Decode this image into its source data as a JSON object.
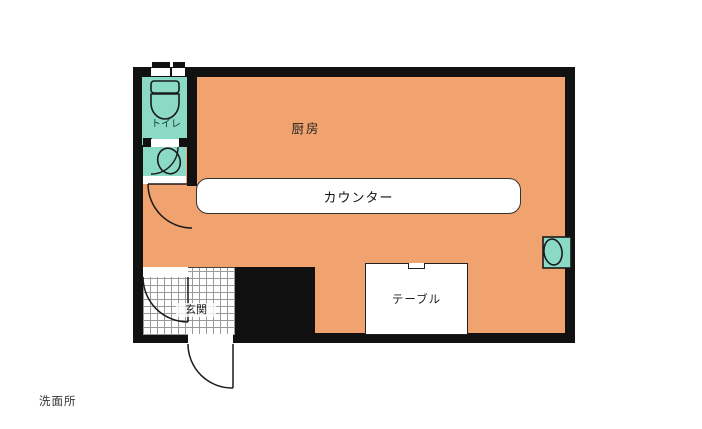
{
  "figure": {
    "type": "floor-plan"
  },
  "rooms": {
    "kitchen": {
      "label": "厨房"
    },
    "toilet": {
      "label": "トイレ"
    },
    "entrance": {
      "label": "玄関"
    },
    "washroom": {
      "label": "洗面所"
    }
  },
  "fixtures": {
    "counter": {
      "label": "カウンター"
    },
    "table": {
      "label": "テーブル"
    }
  },
  "colors": {
    "floor_orange": "#f0a36e",
    "fixture_teal": "#8bdac6",
    "wall_black": "#111111",
    "grid_line": "#9a9a9a",
    "counter_white": "#ffffff",
    "line_dark": "#1a1a1a",
    "background": "#ffffff"
  }
}
